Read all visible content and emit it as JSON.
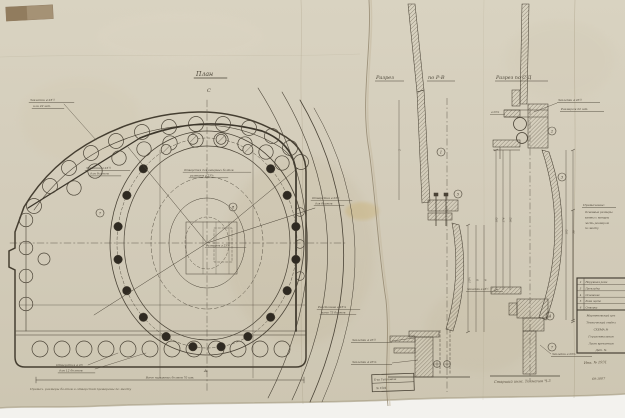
{
  "paper": {
    "bg_top": "#d9d3c1",
    "bg_bottom": "#cdc6b2",
    "ink": "#4a4336",
    "scan_bg": "#f3f2ee"
  },
  "plan": {
    "title": "План",
    "axis_top": "С",
    "axis_bottom": "А.",
    "callout_7": "7",
    "callout_8": "8",
    "labels": {
      "rivets_tl_1": "Заклепки ⌀ 23½",
      "rivets_tl_2": "или 22 шт.",
      "holes_ml_1": "Заклепки ⌀ 23¾",
      "holes_ml_2": "для болтов",
      "center_1": "Отверстия для анкерных болтов",
      "center_2": "размером ⌀ 23⅞",
      "size_center": "Размером ⌀ 23⅞",
      "holes_bl_1": "Отверстия ⌀ 23",
      "holes_bl_2": "для 12 болтов",
      "right_top_1": "Отверстия ⌀ 23¾",
      "right_top_2": "для болтов",
      "right_bot_1": "Расстояние ⌀ 23⅞",
      "right_bot_2": "всего 75 болтов",
      "bottom_dim": "Всего наружных болтов 70 шт.",
      "note": "Примеч.  размеры болтов и отверстий проверены по месту"
    }
  },
  "section_rv": {
    "title_1": "Разрез",
    "title_2": "по Р-В",
    "callout_1": "1",
    "callout_5": "5",
    "labels": {
      "rivets_1": "Заклепки ⌀ 23½",
      "rivets_2": "Заклепки ⌀ 23⅞"
    },
    "dims": [
      "10¾",
      "8",
      "6",
      "2"
    ]
  },
  "section_sd": {
    "title": "Разрез по С-Д",
    "callout_2": "2",
    "callout_3": "3",
    "callout_4": "4",
    "callout_7": "7",
    "labels": {
      "top_1": "Заклепки ⌀ 23½",
      "top_2": "Размером 22 шт.",
      "left_small": "⌀ 23⅞",
      "mid_left": "Заклепки ⌀ 23½",
      "bottom_right": "Заклепки ⌀ 23⅞"
    },
    "dims": [
      "195",
      "174",
      "162",
      "105",
      "38"
    ],
    "signature": "Старший инж.  Толмачев  Ч-3"
  },
  "stamp": {
    "line1": "Б-ка Гипромеза",
    "line2": "№ 1504"
  },
  "notes_panel": {
    "heading": "Примечание:",
    "lines": [
      "Основные размеры",
      "взяты с натуры",
      "часть размером",
      "по месту"
    ]
  },
  "title_block": {
    "items": [
      {
        "num": "2",
        "text": "Наружная рама"
      },
      {
        "num": "3",
        "text": "Прокладка"
      },
      {
        "num": "4",
        "text": "Основание"
      },
      {
        "num": "5",
        "text": "Рама щита"
      },
      {
        "num": "6",
        "text": "Створка"
      }
    ],
    "rows": [
      "Мартеновский цех",
      "Технический отдел",
      "СХЕМА №",
      "Горизонтальная",
      "Лист крепления",
      "Дет. №"
    ],
    "inv_1": "Инв. № 1931",
    "inv_2": "69-1007"
  }
}
